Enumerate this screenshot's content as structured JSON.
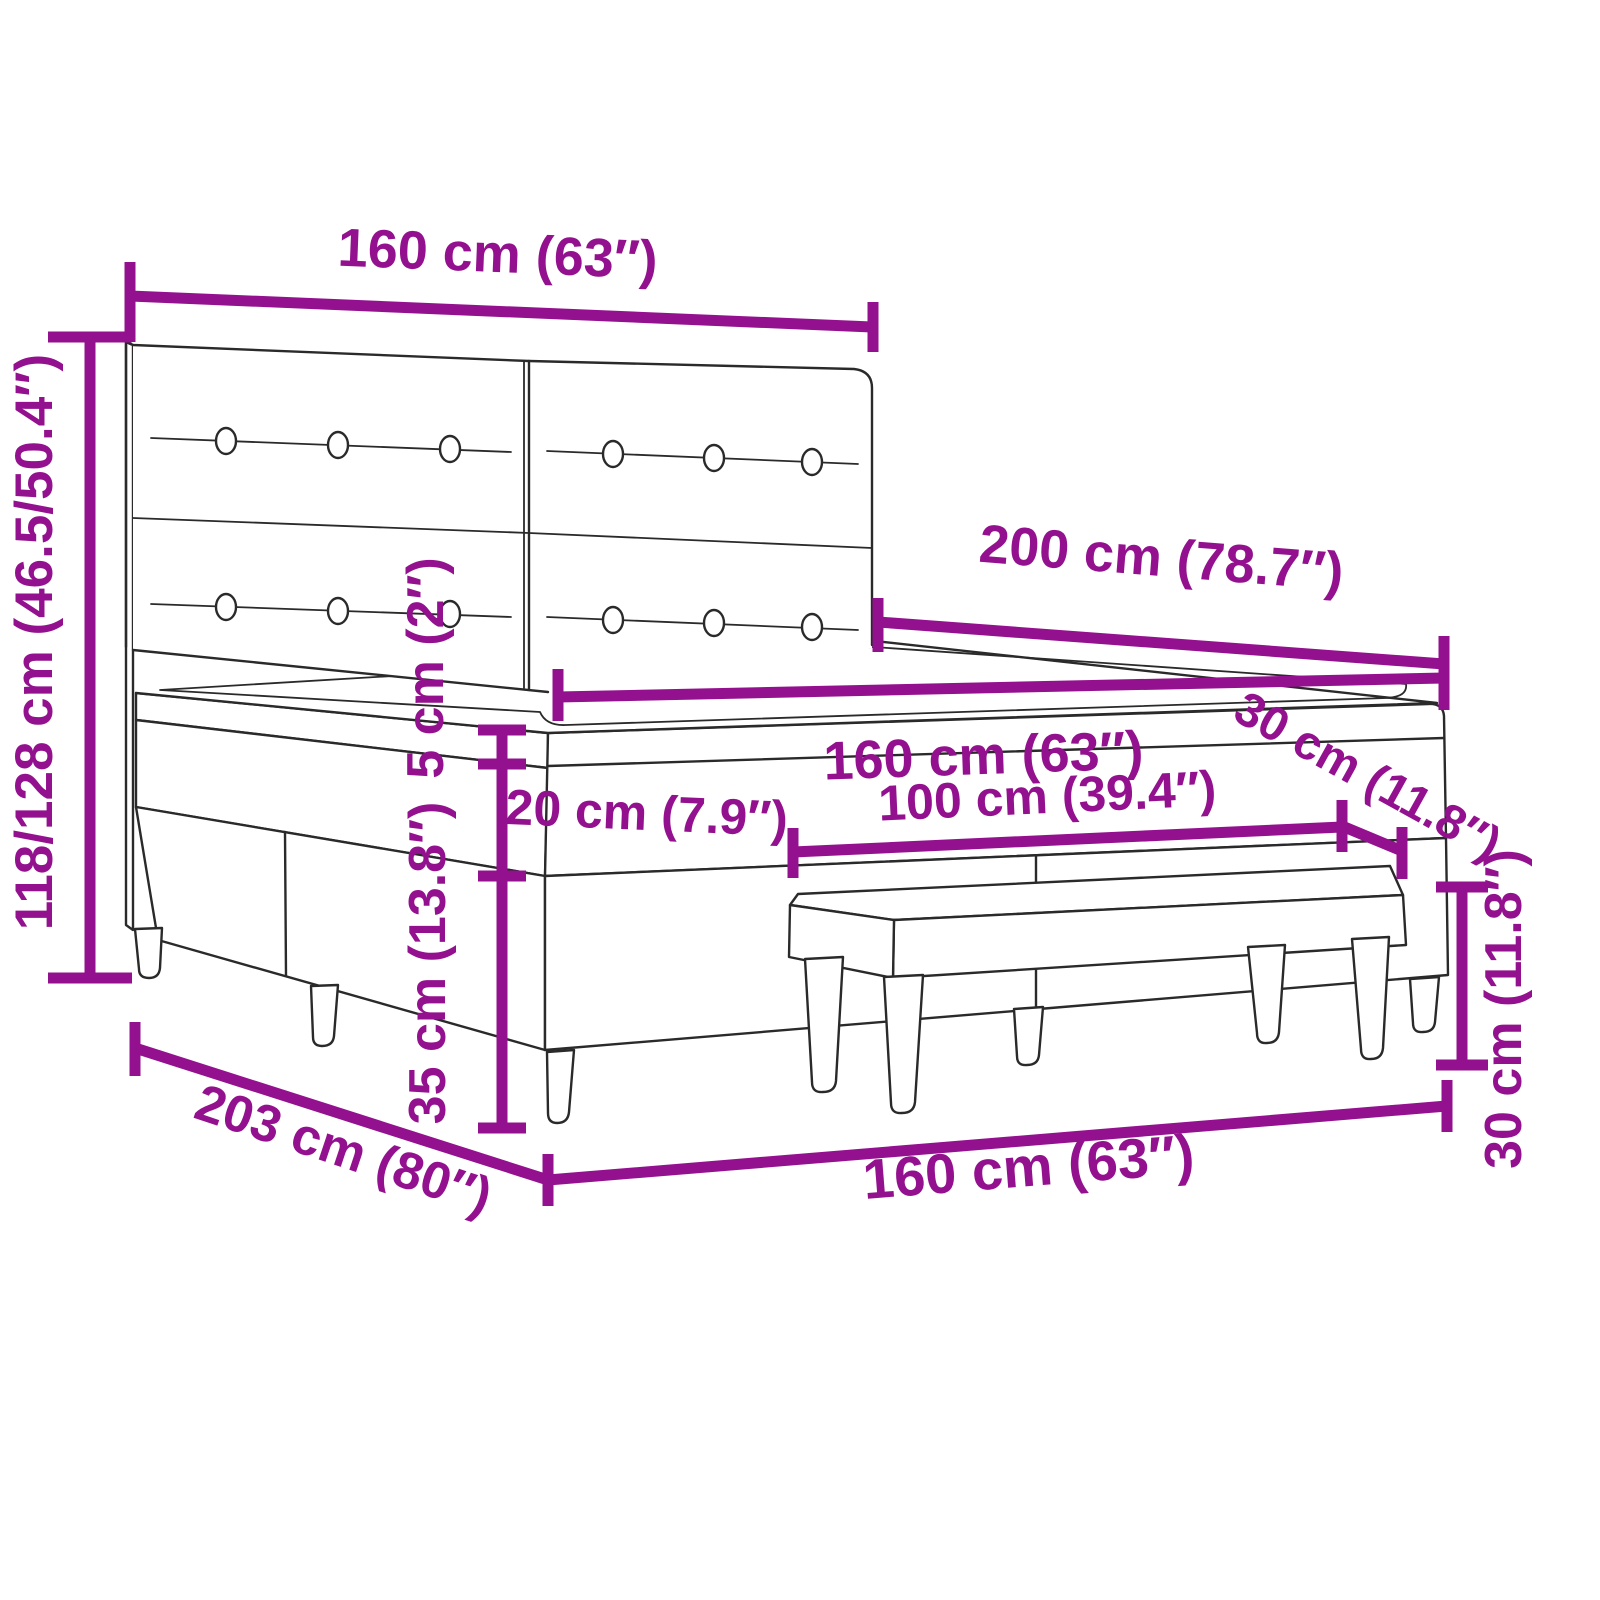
{
  "page": {
    "background": "#ffffff",
    "type": "product-dimension-diagram",
    "subject": "box spring bed with two-panel tufted headboard, pillow-top mattress and upholstered bench",
    "colors": {
      "dimension_annotation": "#93118E",
      "drawing_outline": "#2a2a2a",
      "surface_fill": "#ffffff"
    }
  },
  "diagram": {
    "measurements": [
      {
        "id": "headboard-width-top",
        "label": "160 cm (63″)",
        "cm": "160",
        "inches": "63"
      },
      {
        "id": "headboard-height-left",
        "label": "118/128 cm (46.5/50.4″)",
        "cm": "118/128",
        "inches": "46.5/50.4"
      },
      {
        "id": "bed-length",
        "label": "200 cm (78.7″)",
        "cm": "200",
        "inches": "78.7"
      },
      {
        "id": "mattress-width",
        "label": "160 cm (63″)",
        "cm": "160",
        "inches": "63"
      },
      {
        "id": "topper-height",
        "label": "5 cm (2″)",
        "cm": "5",
        "inches": "2"
      },
      {
        "id": "mattress-height",
        "label": "20 cm (7.9″)",
        "cm": "20",
        "inches": "7.9"
      },
      {
        "id": "base-height",
        "label": "35 cm (13.8″)",
        "cm": "35",
        "inches": "13.8"
      },
      {
        "id": "bench-depth",
        "label": "30 cm (11.8″)",
        "cm": "30",
        "inches": "11.8"
      },
      {
        "id": "bench-length",
        "label": "100 cm (39.4″)",
        "cm": "100",
        "inches": "39.4"
      },
      {
        "id": "bench-height",
        "label": "30 cm (11.8″)",
        "cm": "30",
        "inches": "11.8"
      },
      {
        "id": "total-length",
        "label": "203 cm (80″)",
        "cm": "203",
        "inches": "80"
      },
      {
        "id": "bed-width-bottom",
        "label": "160 cm (63″)",
        "cm": "160",
        "inches": "63"
      }
    ]
  }
}
